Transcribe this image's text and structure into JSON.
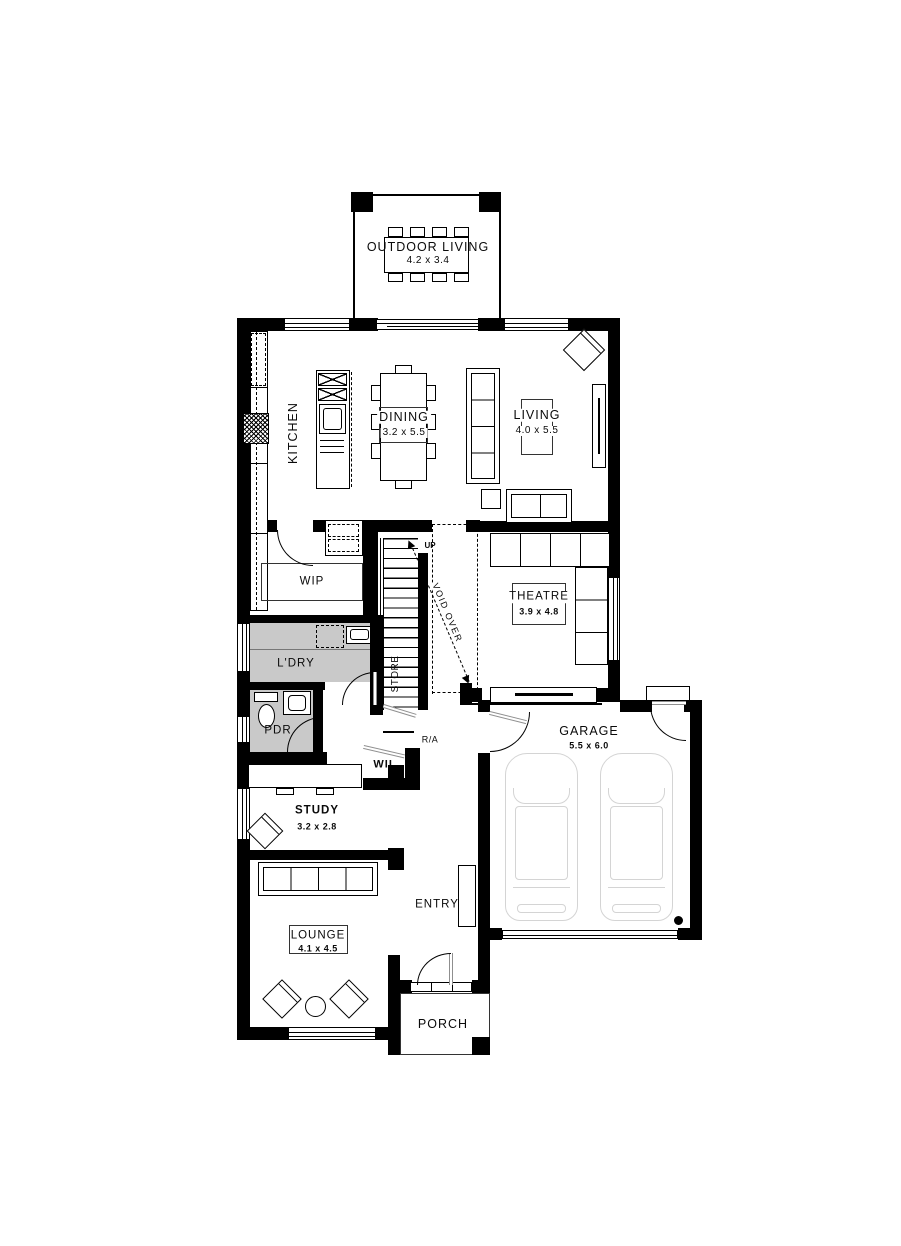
{
  "plan": {
    "title": "single-storey house floor plan, ground floor",
    "rooms": {
      "outdoor_living": {
        "label": "OUTDOOR LIVING",
        "dim": "4.2 x 3.4"
      },
      "kitchen": {
        "label": "KITCHEN"
      },
      "dining": {
        "label": "DINING",
        "dim": "3.2 x 5.5"
      },
      "living": {
        "label": "LIVING",
        "dim": "4.0 x 5.5"
      },
      "wip": {
        "label": "WIP"
      },
      "theatre": {
        "label": "THEATRE",
        "dim": "3.9 x 4.8"
      },
      "laundry": {
        "label": "L'DRY"
      },
      "store": {
        "label": "STORE"
      },
      "powder": {
        "label": "PDR"
      },
      "wil": {
        "label": "WIL"
      },
      "study": {
        "label": "STUDY",
        "dim": "3.2 x 2.8"
      },
      "entry": {
        "label": "ENTRY"
      },
      "lounge": {
        "label": "LOUNGE",
        "dim": "4.1 x 4.5"
      },
      "garage": {
        "label": "GARAGE",
        "dim": "5.5 x 6.0"
      },
      "porch": {
        "label": "PORCH"
      }
    },
    "annotations": {
      "up": "UP",
      "void_over": "VOID OVER",
      "return_air": "R/A"
    },
    "colors": {
      "wall": "#000000",
      "wet_area_floor": "#c9c9c9",
      "door_leaf": "#8f8f8f",
      "car_outline": "#d4d4d4"
    }
  }
}
